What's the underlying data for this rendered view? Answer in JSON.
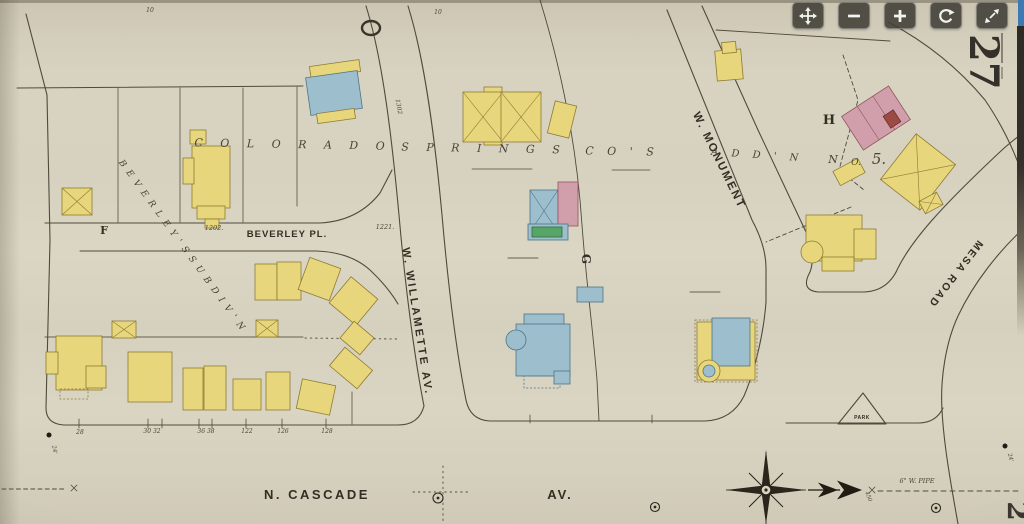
{
  "viewer": {
    "sheet_number": "27",
    "adjacent_sheet_number_partial": "2",
    "edge_accent_color": "#3d7ab5",
    "controls": [
      {
        "name": "pan-control",
        "title": "Pan",
        "icon": "move-arrows-icon"
      },
      {
        "name": "zoom-out-control",
        "title": "Zoom out",
        "icon": "minus-icon"
      },
      {
        "name": "zoom-in-control",
        "title": "Zoom in",
        "icon": "plus-icon"
      },
      {
        "name": "rotate-control",
        "title": "Rotate",
        "icon": "rotate-arrow-icon"
      },
      {
        "name": "fullscreen-control",
        "title": "Full screen",
        "icon": "expand-arrows-icon"
      }
    ]
  },
  "map": {
    "paper_color": "#d8d3c1",
    "line_color": "#4f4a3b",
    "palette": {
      "Y": {
        "f": "#e7d67b",
        "s": "#8e7b33"
      },
      "B": {
        "f": "#9cbecd",
        "s": "#4f7587"
      },
      "P": {
        "f": "#d19fab",
        "s": "#92545e"
      },
      "G": {
        "f": "#57a668",
        "s": "#2f6e3e"
      },
      "R": {
        "f": "#9c4a44",
        "s": "#6e2f2a"
      }
    },
    "labels": [
      {
        "t": "C O L O R A D O",
        "x": 293,
        "y": 148,
        "fs": 11,
        "f": "si",
        "ls": 7,
        "rot": 1
      },
      {
        "t": "S P R I N G S",
        "x": 484,
        "y": 152,
        "fs": 11,
        "f": "si",
        "ls": 7,
        "rot": 1
      },
      {
        "t": "C O ' S",
        "x": 622,
        "y": 155,
        "fs": 11,
        "f": "si",
        "ls": 5,
        "rot": 1
      },
      {
        "t": "B E V E R L E Y ' S   S U B D I V ' N",
        "x": 180,
        "y": 247,
        "fs": 9,
        "f": "si",
        "ls": 1.5,
        "rot": 54
      },
      {
        "t": "BEVERLEY  PL.",
        "x": 287,
        "y": 237,
        "fs": 9.5,
        "f": "sb",
        "ls": 1
      },
      {
        "t": "W.  WILLAMETTE  AV.",
        "x": 414,
        "y": 322,
        "fs": 11,
        "f": "sb",
        "ls": 2.5,
        "rot": 81
      },
      {
        "t": "W. MONUMENT",
        "x": 716,
        "y": 162,
        "fs": 11.5,
        "f": "sb",
        "ls": 2,
        "rot": 64
      },
      {
        "t": "MESA  ROAD",
        "x": 953,
        "y": 272,
        "fs": 10.5,
        "f": "sb",
        "ls": 2,
        "rot": 128
      },
      {
        "t": "N.  CASCADE",
        "x": 317,
        "y": 499,
        "fs": 13,
        "f": "sb",
        "ls": 2.5
      },
      {
        "t": "AV.",
        "x": 560,
        "y": 499,
        "fs": 13,
        "f": "sb",
        "ls": 2
      },
      {
        "t": "A D D ' N",
        "x": 757,
        "y": 158,
        "fs": 10,
        "f": "si",
        "ls": 5,
        "rot": 4
      },
      {
        "t": "N",
        "x": 833,
        "y": 163,
        "fs": 11,
        "f": "si"
      },
      {
        "t": "O.",
        "x": 856,
        "y": 165,
        "fs": 9,
        "f": "si"
      },
      {
        "t": "5.",
        "x": 879,
        "y": 164,
        "fs": 15,
        "f": "si"
      },
      {
        "t": "H",
        "x": 829,
        "y": 124,
        "fs": 13,
        "f": "rb"
      },
      {
        "t": "G",
        "x": 582,
        "y": 259,
        "fs": 12,
        "f": "rb",
        "rot": 90
      },
      {
        "t": "F",
        "x": 104,
        "y": 234,
        "fs": 11,
        "f": "rb"
      },
      {
        "t": "PARK",
        "x": 862,
        "y": 419,
        "fs": 5,
        "f": "sb",
        "ls": 0.5
      },
      {
        "t": "1202.",
        "x": 214,
        "y": 230,
        "fs": 6.5,
        "f": "si"
      },
      {
        "t": "1221.",
        "x": 385,
        "y": 229,
        "fs": 6.5,
        "f": "si"
      },
      {
        "t": "1302",
        "x": 397,
        "y": 107,
        "fs": 6,
        "f": "si",
        "rot": 80
      },
      {
        "t": "28",
        "x": 80,
        "y": 434,
        "fs": 6,
        "f": "si"
      },
      {
        "t": "30  32",
        "x": 152,
        "y": 433,
        "fs": 6,
        "f": "si"
      },
      {
        "t": "36  38",
        "x": 206,
        "y": 433,
        "fs": 6,
        "f": "si"
      },
      {
        "t": "122",
        "x": 247,
        "y": 433,
        "fs": 6,
        "f": "si"
      },
      {
        "t": "126",
        "x": 283,
        "y": 433,
        "fs": 6,
        "f": "si"
      },
      {
        "t": "128",
        "x": 327,
        "y": 433,
        "fs": 6,
        "f": "si"
      },
      {
        "t": "10",
        "x": 150,
        "y": 12,
        "fs": 6,
        "f": "si"
      },
      {
        "t": "10",
        "x": 438,
        "y": 14,
        "fs": 6,
        "f": "si"
      },
      {
        "t": "6\" W. PIPE",
        "x": 917,
        "y": 483,
        "fs": 6.5,
        "f": "si"
      },
      {
        "t": "450",
        "x": 867,
        "y": 497,
        "fs": 5.5,
        "f": "si",
        "rot": 70
      },
      {
        "t": "24'",
        "x": 1009,
        "y": 458,
        "fs": 5.5,
        "f": "si",
        "rot": 75
      },
      {
        "t": "24'",
        "x": 53,
        "y": 450,
        "fs": 5.5,
        "f": "si",
        "rot": 80
      }
    ],
    "buildings": [
      [
        310,
        63,
        50,
        12,
        -8,
        "Y",
        "r"
      ],
      [
        308,
        74,
        52,
        38,
        -8,
        "B",
        "r"
      ],
      [
        317,
        111,
        38,
        10,
        -8,
        "Y",
        "r"
      ],
      [
        484,
        87,
        18,
        58,
        0,
        "Y",
        "r"
      ],
      [
        463,
        92,
        40,
        50,
        0,
        "Y",
        "b"
      ],
      [
        501,
        92,
        40,
        50,
        0,
        "Y",
        "b"
      ],
      [
        551,
        103,
        22,
        33,
        14,
        "Y",
        "r"
      ],
      [
        716,
        50,
        26,
        30,
        -5,
        "Y",
        "r"
      ],
      [
        722,
        42,
        14,
        11,
        -5,
        "Y",
        "r"
      ],
      [
        848,
        98,
        56,
        40,
        -33,
        "P",
        "p"
      ],
      [
        886,
        112,
        12,
        14,
        -33,
        "R",
        "r"
      ],
      [
        893,
        143,
        50,
        58,
        38,
        "Y",
        "b"
      ],
      [
        835,
        164,
        28,
        16,
        -28,
        "Y",
        "r"
      ],
      [
        806,
        215,
        56,
        46,
        0,
        "Y",
        "r"
      ],
      [
        854,
        229,
        22,
        30,
        0,
        "Y",
        "r"
      ],
      [
        812,
        252,
        11,
        0,
        0,
        "Y",
        "c"
      ],
      [
        822,
        257,
        32,
        14,
        0,
        "Y",
        "r"
      ],
      [
        921,
        196,
        20,
        14,
        -28,
        "Y",
        "x"
      ],
      [
        62,
        188,
        30,
        27,
        0,
        "Y",
        "x"
      ],
      [
        190,
        130,
        16,
        14,
        0,
        "Y",
        "r"
      ],
      [
        192,
        146,
        38,
        62,
        0,
        "Y",
        "r"
      ],
      [
        183,
        158,
        11,
        26,
        0,
        "Y",
        "r"
      ],
      [
        197,
        206,
        28,
        13,
        0,
        "Y",
        "r"
      ],
      [
        205,
        219,
        14,
        9,
        0,
        "Y",
        "r"
      ],
      [
        255,
        264,
        22,
        36,
        0,
        "Y",
        "r"
      ],
      [
        277,
        262,
        24,
        38,
        0,
        "Y",
        "r"
      ],
      [
        303,
        262,
        33,
        34,
        20,
        "Y",
        "r"
      ],
      [
        336,
        284,
        35,
        34,
        40,
        "Y",
        "r"
      ],
      [
        256,
        320,
        22,
        17,
        0,
        "Y",
        "x"
      ],
      [
        112,
        321,
        24,
        17,
        0,
        "Y",
        "x"
      ],
      [
        344,
        327,
        26,
        22,
        40,
        "Y",
        "r"
      ],
      [
        333,
        356,
        36,
        24,
        40,
        "Y",
        "r"
      ],
      [
        56,
        336,
        46,
        54,
        0,
        "Y",
        "r"
      ],
      [
        46,
        352,
        12,
        22,
        0,
        "Y",
        "r"
      ],
      [
        86,
        366,
        20,
        22,
        0,
        "Y",
        "r"
      ],
      [
        60,
        389,
        28,
        10,
        0,
        "Y",
        "d"
      ],
      [
        128,
        352,
        44,
        50,
        0,
        "Y",
        "r"
      ],
      [
        183,
        368,
        20,
        42,
        0,
        "Y",
        "r"
      ],
      [
        204,
        366,
        22,
        44,
        0,
        "Y",
        "r"
      ],
      [
        233,
        379,
        28,
        31,
        0,
        "Y",
        "r"
      ],
      [
        266,
        372,
        24,
        38,
        0,
        "Y",
        "r"
      ],
      [
        299,
        382,
        34,
        30,
        12,
        "Y",
        "r"
      ],
      [
        530,
        190,
        28,
        42,
        0,
        "B",
        "b"
      ],
      [
        558,
        182,
        20,
        44,
        0,
        "P",
        "r"
      ],
      [
        528,
        224,
        40,
        16,
        0,
        "B",
        "r"
      ],
      [
        532,
        227,
        30,
        10,
        0,
        "G",
        "r"
      ],
      [
        577,
        287,
        26,
        15,
        0,
        "B",
        "r"
      ],
      [
        524,
        314,
        40,
        12,
        0,
        "B",
        "r"
      ],
      [
        516,
        324,
        54,
        52,
        0,
        "B",
        "r"
      ],
      [
        516,
        340,
        10,
        0,
        0,
        "B",
        "c"
      ],
      [
        524,
        376,
        36,
        12,
        0,
        "B",
        "d"
      ],
      [
        554,
        371,
        16,
        13,
        0,
        "B",
        "r"
      ],
      [
        695,
        320,
        62,
        62,
        0,
        "Y",
        "d"
      ],
      [
        697,
        322,
        58,
        58,
        0,
        "Y",
        "r"
      ],
      [
        712,
        318,
        38,
        48,
        0,
        "B",
        "r"
      ],
      [
        709,
        371,
        11,
        0,
        0,
        "Y",
        "c"
      ],
      [
        709,
        371,
        6,
        0,
        0,
        "B",
        "c"
      ]
    ],
    "symbols": {
      "circled_markers": [
        [
          438,
          498,
          5
        ],
        [
          655,
          507,
          4.5
        ],
        [
          936,
          508,
          4.5
        ]
      ],
      "dots": [
        [
          1005,
          446,
          2.5
        ],
        [
          49,
          435,
          2.5
        ]
      ],
      "compass": {
        "cx": 766,
        "cy": 490
      }
    }
  }
}
